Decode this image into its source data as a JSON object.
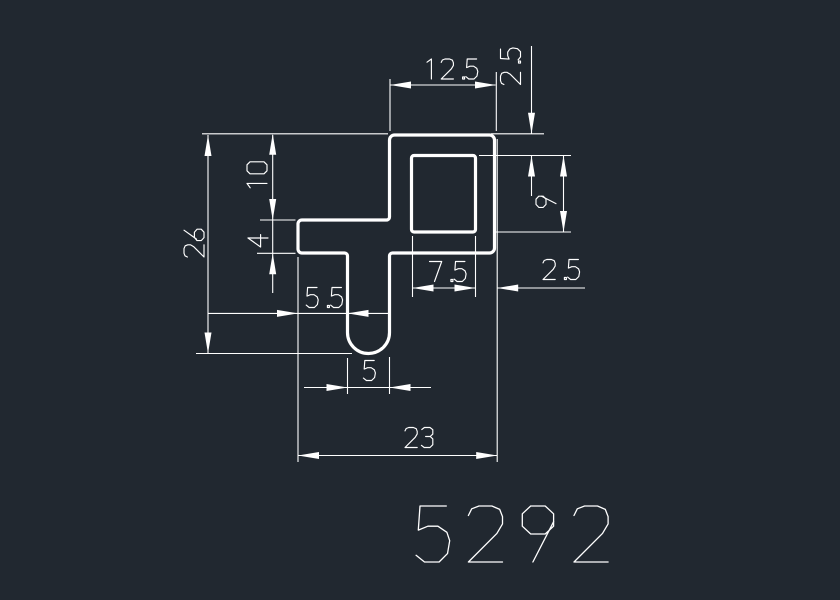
{
  "app": {
    "background_color": "#212830",
    "line_color": "#ffffff"
  },
  "drawing": {
    "part_number": "5292",
    "dimensions": {
      "top_width": "12.5",
      "top_wall_thickness": "2.5",
      "pocket_height": "9",
      "flange_offset_top": "10",
      "flange_thickness": "4",
      "overall_height": "26",
      "tab_offset_left": "5.5",
      "pocket_width": "7.5",
      "right_wall_thickness": "2.5",
      "tab_width": "5",
      "overall_width": "23"
    }
  }
}
